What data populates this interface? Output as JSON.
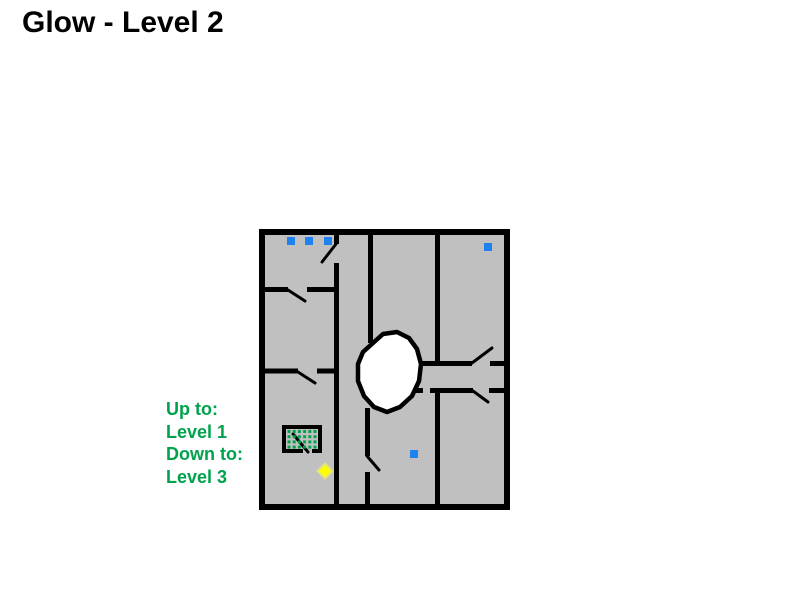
{
  "page": {
    "title": "Glow - Level 2",
    "background_color": "#FFFFFF",
    "title_color": "#000000"
  },
  "legend": {
    "color": "#00A24C",
    "lines": [
      "Up to:",
      "Level 1",
      "Down to:",
      "Level 3"
    ]
  },
  "map": {
    "background_color": "#C0C0C0",
    "wall_color": "#000000",
    "frame": {
      "x": 262,
      "y": 232,
      "w": 245,
      "h": 275,
      "stroke_width": 6
    },
    "wall_stroke_width": 5,
    "door_stroke_width": 3,
    "walls": [
      {
        "name": "wall-a-top-stub",
        "x1": 336.5,
        "y1": 229,
        "x2": 336.5,
        "y2": 244
      },
      {
        "name": "wall-a-main",
        "x1": 336.5,
        "y1": 263,
        "x2": 336.5,
        "y2": 507
      },
      {
        "name": "left-room-wall1-left",
        "x1": 261,
        "y1": 289.5,
        "x2": 288,
        "y2": 289.5
      },
      {
        "name": "left-room-wall1-right",
        "x1": 307,
        "y1": 289.5,
        "x2": 339,
        "y2": 289.5
      },
      {
        "name": "left-room-wall2-left",
        "x1": 261,
        "y1": 371,
        "x2": 298,
        "y2": 371
      },
      {
        "name": "left-room-wall2-right",
        "x1": 317,
        "y1": 371,
        "x2": 339,
        "y2": 371
      },
      {
        "name": "wall-b-top",
        "x1": 370.5,
        "y1": 229,
        "x2": 370.5,
        "y2": 343
      },
      {
        "name": "wall-b-mid",
        "x1": 367.5,
        "y1": 408,
        "x2": 367.5,
        "y2": 456
      },
      {
        "name": "wall-b-bottom",
        "x1": 367.5,
        "y1": 472,
        "x2": 367.5,
        "y2": 507
      },
      {
        "name": "wall-c-top",
        "x1": 437.5,
        "y1": 229,
        "x2": 437.5,
        "y2": 365
      },
      {
        "name": "wall-c-bottom",
        "x1": 437.5,
        "y1": 390,
        "x2": 437.5,
        "y2": 507
      },
      {
        "name": "corridor-top-left",
        "x1": 417,
        "y1": 363.5,
        "x2": 472,
        "y2": 363.5
      },
      {
        "name": "corridor-top-right",
        "x1": 490,
        "y1": 363.5,
        "x2": 505,
        "y2": 363.5
      },
      {
        "name": "corridor-bottom-a",
        "x1": 403,
        "y1": 390.5,
        "x2": 423,
        "y2": 390.5
      },
      {
        "name": "corridor-bottom-b",
        "x1": 430,
        "y1": 390.5,
        "x2": 473,
        "y2": 390.5
      },
      {
        "name": "corridor-bottom-c",
        "x1": 489,
        "y1": 390.5,
        "x2": 505,
        "y2": 390.5
      }
    ],
    "doors": [
      {
        "name": "door-top-left",
        "x1": 336,
        "y1": 244,
        "x2": 322,
        "y2": 262
      },
      {
        "name": "door-left-room1",
        "x1": 288,
        "y1": 290,
        "x2": 305,
        "y2": 301
      },
      {
        "name": "door-left-room2",
        "x1": 298,
        "y1": 372,
        "x2": 315,
        "y2": 383
      },
      {
        "name": "door-wall-b",
        "x1": 367,
        "y1": 456,
        "x2": 379,
        "y2": 470
      },
      {
        "name": "door-corridor-top",
        "x1": 472,
        "y1": 363,
        "x2": 492,
        "y2": 348
      },
      {
        "name": "door-corridor-bottom",
        "x1": 473,
        "y1": 391,
        "x2": 488,
        "y2": 402
      }
    ],
    "hole": {
      "fill": "#FFFFFF",
      "stroke_width": 4.5,
      "points": [
        [
          373,
          343
        ],
        [
          383,
          334
        ],
        [
          397,
          332
        ],
        [
          409,
          338
        ],
        [
          417,
          349
        ],
        [
          421,
          364
        ],
        [
          419,
          381
        ],
        [
          412,
          396
        ],
        [
          400,
          407
        ],
        [
          387,
          412
        ],
        [
          374,
          407
        ],
        [
          364,
          396
        ],
        [
          358,
          381
        ],
        [
          358,
          364
        ],
        [
          363,
          352
        ]
      ]
    },
    "storage_box": {
      "rect": {
        "x": 284,
        "y": 427,
        "w": 36,
        "h": 24,
        "stroke_width": 4
      },
      "gap": {
        "x1": 303,
        "y1": 451,
        "x2": 312,
        "y2": 451
      },
      "door": {
        "x1": 293,
        "y1": 434,
        "x2": 308,
        "y2": 452
      },
      "dots": {
        "x0": 287.5,
        "y0": 430,
        "cols": 6,
        "rows": 4,
        "pitch": 5.2,
        "size": 3,
        "color": "#00A24C"
      }
    },
    "items": {
      "blue_color": "#1E82F0",
      "blue_size": 8,
      "blue_squares": [
        {
          "x": 287,
          "y": 237
        },
        {
          "x": 305,
          "y": 237
        },
        {
          "x": 324,
          "y": 237
        },
        {
          "x": 484,
          "y": 243
        },
        {
          "x": 410,
          "y": 450
        }
      ],
      "diamond": {
        "cx": 325,
        "cy": 471,
        "r": 7.5,
        "fill": "#FFFF00",
        "stroke": "#E2E27E"
      }
    }
  }
}
